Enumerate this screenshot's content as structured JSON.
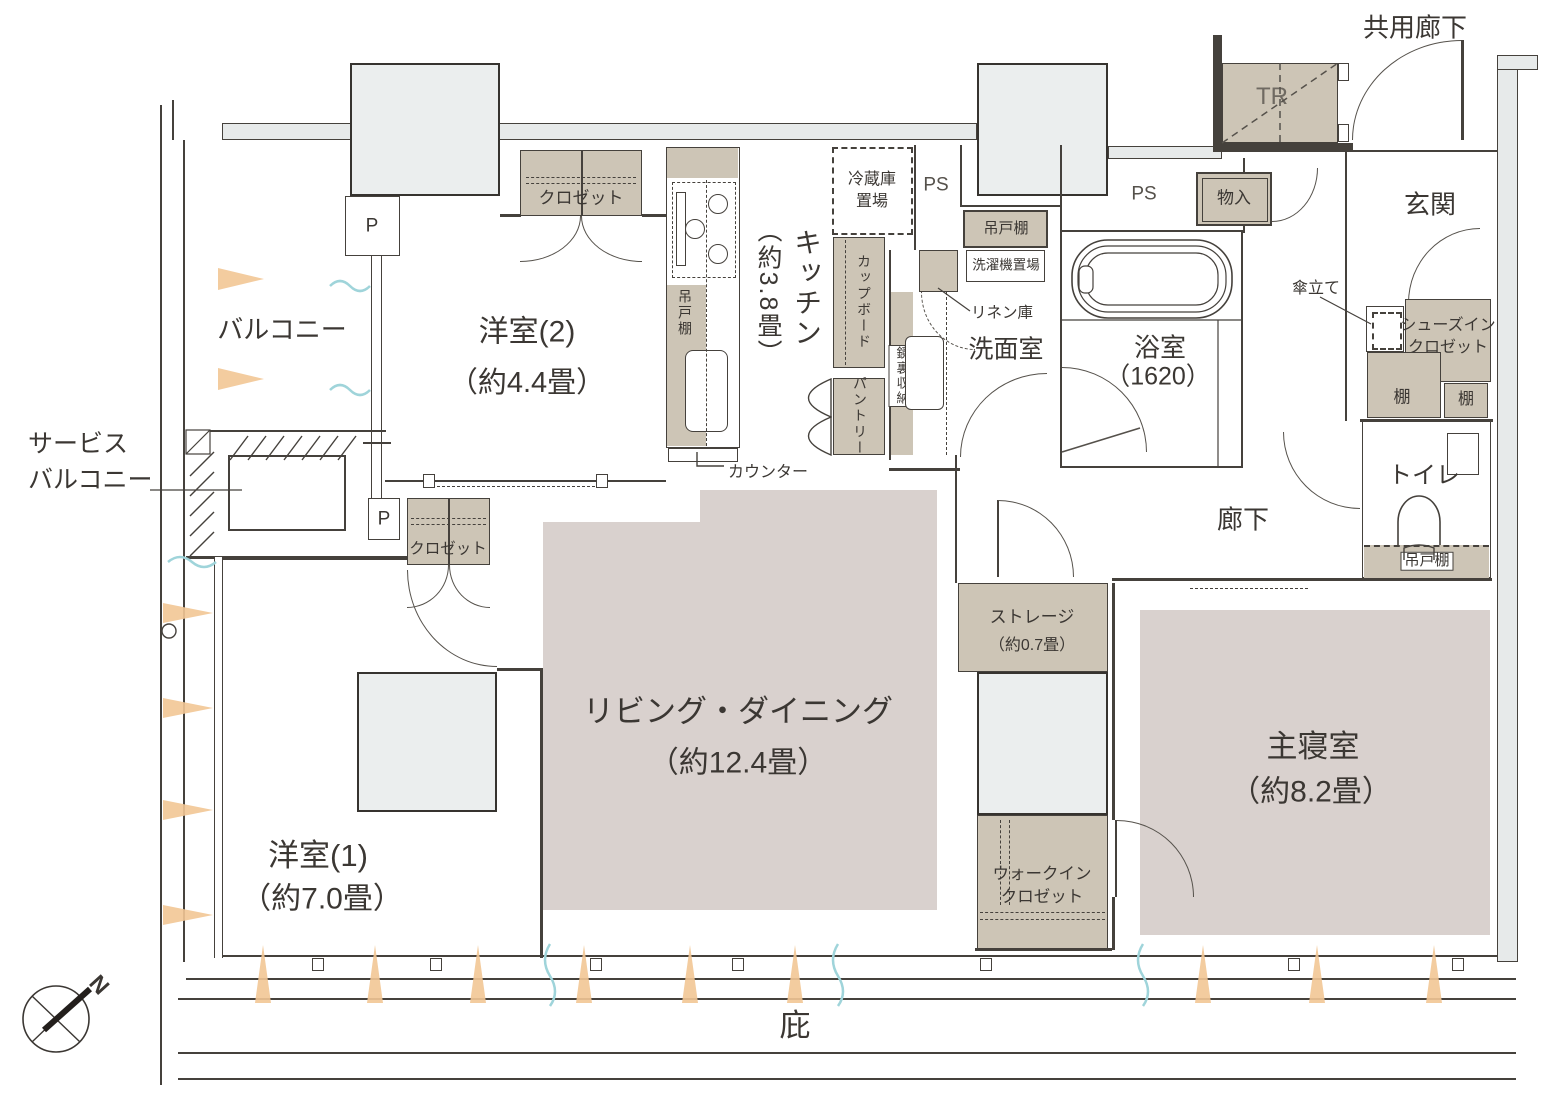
{
  "colors": {
    "shade_fill": "#cdc5b6",
    "room_fill": "#d9d1ce",
    "pillar_fill": "#ebeeee",
    "wall_line": "#45413c",
    "sun_arrow": "#f2c695",
    "breeze": "#9fd4da"
  },
  "rooms": {
    "living": {
      "name": "リビング・ダイニング",
      "size": "（約12.4畳）"
    },
    "master_bedroom": {
      "name": "主寝室",
      "size": "（約8.2畳）"
    },
    "western_room_1": {
      "name": "洋室(1)",
      "size": "（約7.0畳）"
    },
    "western_room_2": {
      "name": "洋室(2)",
      "size": "（約4.4畳）"
    },
    "kitchen": {
      "name": "キッチン",
      "size": "（約3.8畳）"
    },
    "bathroom": {
      "name": "浴室",
      "size": "（1620）"
    },
    "washroom": {
      "name": "洗面室"
    },
    "toilet": {
      "name": "トイレ"
    },
    "entrance": {
      "name": "玄関"
    },
    "corridor": {
      "name": "廊下"
    },
    "common_corridor": {
      "name": "共用廊下"
    },
    "balcony": {
      "name": "バルコニー"
    },
    "service_balcony": {
      "line1": "サービス",
      "line2": "バルコニー"
    },
    "storage_room": {
      "name": "ストレージ",
      "size": "（約0.7畳）"
    },
    "walk_in_closet": {
      "line1": "ウォークイン",
      "line2": "クロゼット"
    },
    "trunk_room": {
      "name": "TR"
    },
    "eaves": {
      "name": "庇"
    }
  },
  "fixtures": {
    "closet_w2": "クロゼット",
    "closet_w1": "クロゼット",
    "refrigerator_line1": "冷蔵庫",
    "refrigerator_line2": "置場",
    "cupboard": "カップボード",
    "pantry": "パントリー",
    "kitchen_hanging_shelf": "吊戸棚",
    "counter": "カウンター",
    "mirror_cabinet": "鏡裏収納",
    "linen_cabinet": "リネン庫",
    "washer_space": "洗濯機置場",
    "washroom_hanging_shelf": "吊戸棚",
    "toilet_hanging_shelf": "吊戸棚",
    "storage_cabinet": "物入",
    "umbrella_stand": "傘立て",
    "shoes_in_closet_line1": "シューズイン",
    "shoes_in_closet_line2": "クロゼット",
    "shelf_left": "棚",
    "shelf_right": "棚",
    "ps_1": "PS",
    "ps_2": "PS",
    "pipe_1": "P",
    "pipe_2": "P"
  },
  "compass": {
    "north_label": "N"
  }
}
